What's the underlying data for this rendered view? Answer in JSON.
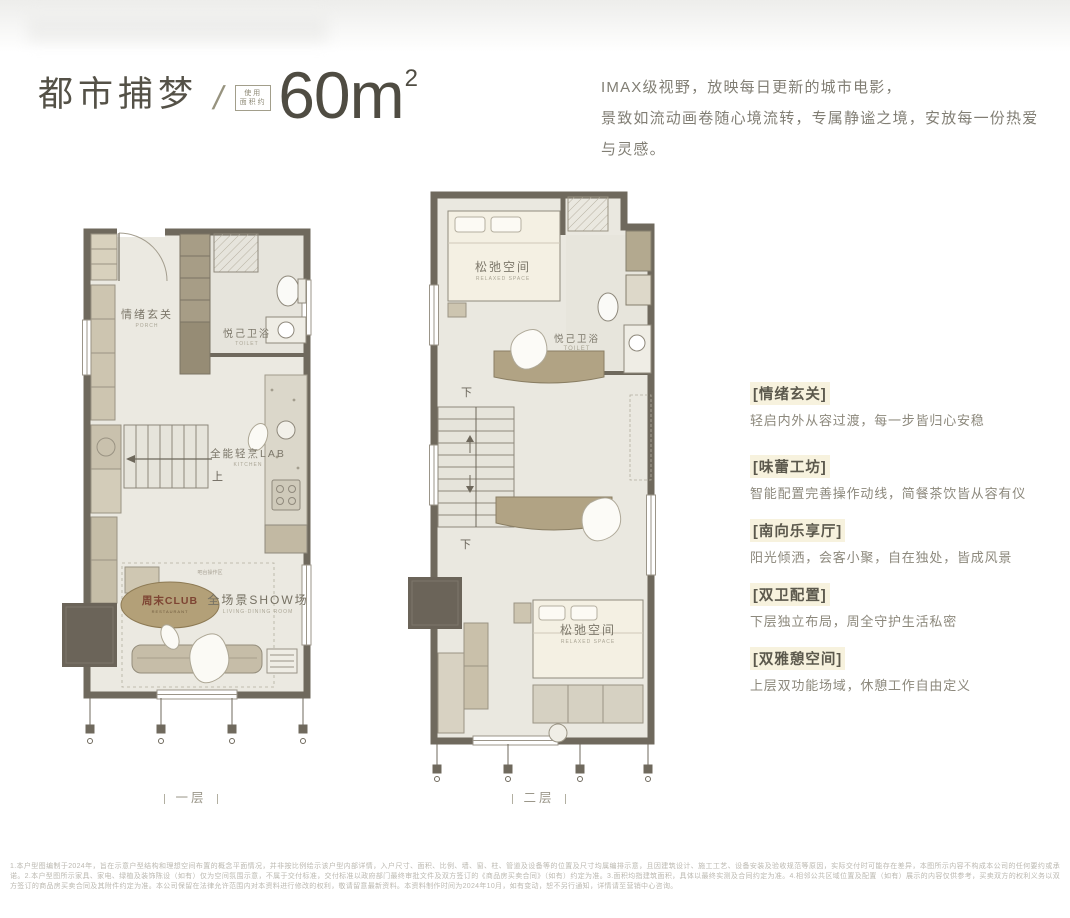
{
  "header": {
    "title": "都市捕梦",
    "separator": "/",
    "area_box_line1": "使用",
    "area_box_line2": "面积约",
    "area_value": "60m",
    "area_sup": "2",
    "tagline_line1": "IMAX级视野，放映每日更新的城市电影，",
    "tagline_line2": "景致如流动画卷随心境流转，专属静谧之境，安放每一份热爱与灵感。"
  },
  "features": [
    {
      "title": "[情绪玄关]",
      "desc": "轻启内外从容过渡，每一步皆归心安稳"
    },
    {
      "title": "[味蕾工坊]",
      "desc": "智能配置完善操作动线，简餐茶饮皆从容有仪"
    },
    {
      "title": "[南向乐享厅]",
      "desc": "阳光倾洒，会客小聚，自在独处，皆成风景"
    },
    {
      "title": "[双卫配置]",
      "desc": "下层独立布局，周全守护生活私密"
    },
    {
      "title": "[双雅憩空间]",
      "desc": "上层双功能场域，休憩工作自由定义"
    }
  ],
  "floor1": {
    "caption": "一层",
    "porch_cn": "情绪玄关",
    "porch_en": "PORCH",
    "toilet_cn": "悦己卫浴",
    "toilet_en": "TOILET",
    "kitchen_cn": "全能轻烹LAB",
    "kitchen_en": "KITCHEN",
    "stairs_up": "上",
    "club_cn": "周末CLUB",
    "club_en": "RESTAURANT",
    "bar_note": "吧台操作区",
    "show_cn": "全场景SHOW场",
    "show_en": "LIVING·DINING ROOM"
  },
  "floor2": {
    "caption": "二层",
    "relax_top_cn": "松弛空间",
    "relax_top_en": "RELAXED SPACE",
    "toilet_cn": "悦己卫浴",
    "toilet_en": "TOILET",
    "stairs_down_a": "下",
    "stairs_down_b": "下",
    "relax_bottom_cn": "松弛空间",
    "relax_bottom_en": "RELAXED SPACE"
  },
  "disclaimer": {
    "text": "1.本户型图编制于2024年，旨在示意户型结构和理想空间布置的概念平面情况，并非按比例绘示该户型内部详情，入户尺寸、面积、比例、墙、窗、柱、管道及设备等的位置及尺寸均属编排示意，且因建筑设计、施工工艺、设备安装及验收规范等原因，实际交付时可能存在差异，本图所示内容不构成本公司的任何要约或承诺。2.本户型图所示家具、家电、绿植及装饰陈设（如有）仅为空间氛围示意，不属于交付标准，交付标准以政府部门最终审批文件及双方签订的《商品房买卖合同》（如有）约定为准。3.面积均指建筑面积，具体以最终实测及合同约定为准。4.相邻公共区域位置及配置（如有）展示的内容仅供参考，买卖双方的权利义务以双方签订的商品房买卖合同及其附件约定为准。本公司保留在法律允许范围内对本资料进行修改的权利，敬请留意最新资料。本资料制作时间为2024年10月，如有变动，恕不另行通知，详情请至营销中心咨询。"
  },
  "palette": {
    "title_text": "#545147",
    "body_text": "#817e74",
    "wall": "#6f695d",
    "plan_floor": "#ebe9e1",
    "furniture_beige": "#c9c0ab",
    "furniture_tan": "#b1a384",
    "cream": "#f4f0e3",
    "badge_fill": "#b3a078",
    "badge_text": "#7e4533",
    "feature_highlight": "#f7f2de",
    "disclaimer_text": "#bbb8b0"
  }
}
